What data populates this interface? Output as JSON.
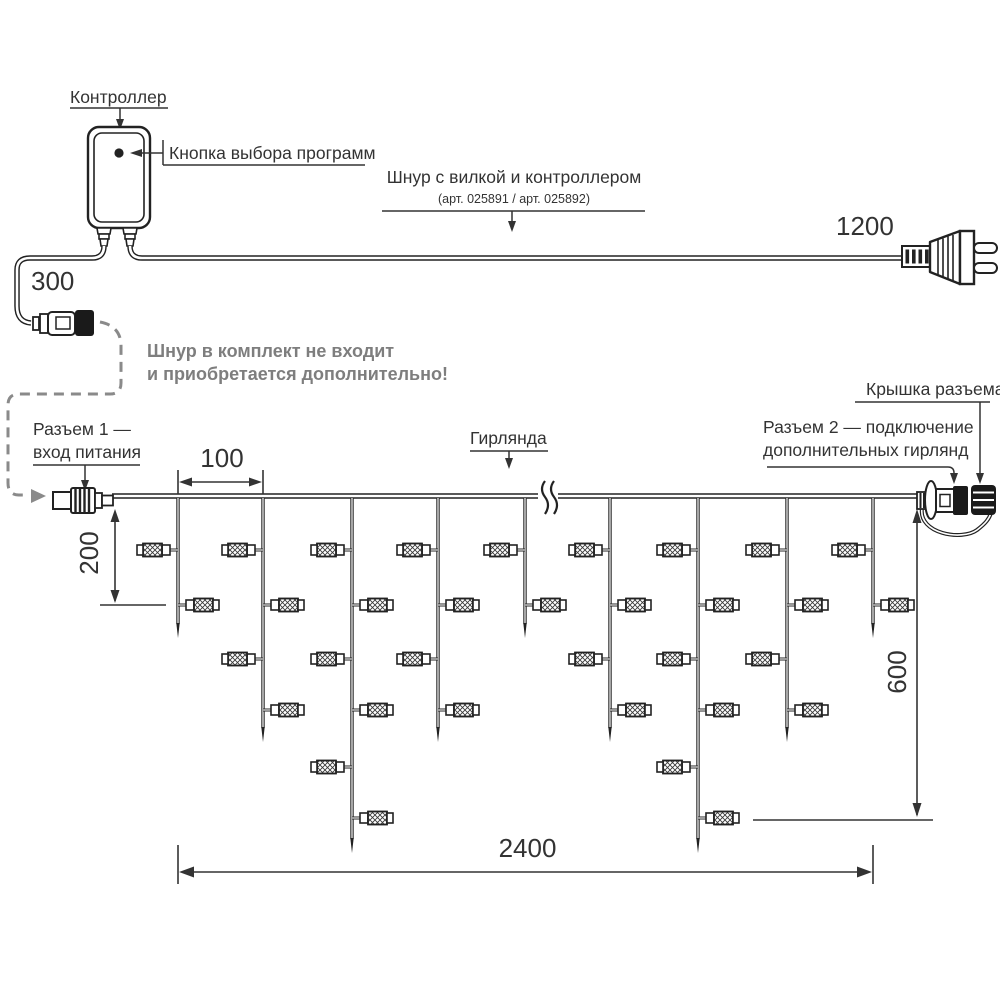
{
  "labels": {
    "controller": "Контроллер",
    "program_button": "Кнопка выбора программ",
    "cord_title": "Шнур с вилкой и контроллером",
    "cord_articles": "(арт. 025891 / арт. 025892)",
    "note_line1": "Шнур в комплект не входит",
    "note_line2": "и приобретается дополнительно!",
    "connector1_line1": "Разъем 1 —",
    "connector1_line2": "вход питания",
    "garland": "Гирлянда",
    "connector_cap": "Крышка разъема",
    "connector2_line1": "Разъем 2 — подключение",
    "connector2_line2": "дополнительных гирлянд"
  },
  "dimensions": {
    "controller_tail": "300",
    "plug_cord": "1200",
    "drop_spacing": "100",
    "min_drop": "200",
    "max_drop": "600",
    "garland_length": "2400"
  },
  "garland": {
    "wire_y": 496,
    "drops": [
      {
        "x": 178,
        "lamps": 2
      },
      {
        "x": 263,
        "lamps": 4
      },
      {
        "x": 352,
        "lamps": 6
      },
      {
        "x": 438,
        "lamps": 4
      },
      {
        "x": 525,
        "lamps": 2
      },
      {
        "x": 610,
        "lamps": 4
      },
      {
        "x": 698,
        "lamps": 6
      },
      {
        "x": 787,
        "lamps": 4
      },
      {
        "x": 873,
        "lamps": 2
      }
    ],
    "lamp_levels_y": [
      550,
      605,
      659,
      710,
      767,
      818
    ],
    "lamp_sides": [
      "left",
      "right",
      "left",
      "right",
      "left",
      "right"
    ],
    "tip_y_by_lamp_count": {
      "2": 638,
      "4": 742,
      "6": 853
    }
  },
  "colors": {
    "line": "#222222",
    "text": "#333333",
    "muted": "#7e7e7e",
    "dash": "#8a8a8a"
  }
}
